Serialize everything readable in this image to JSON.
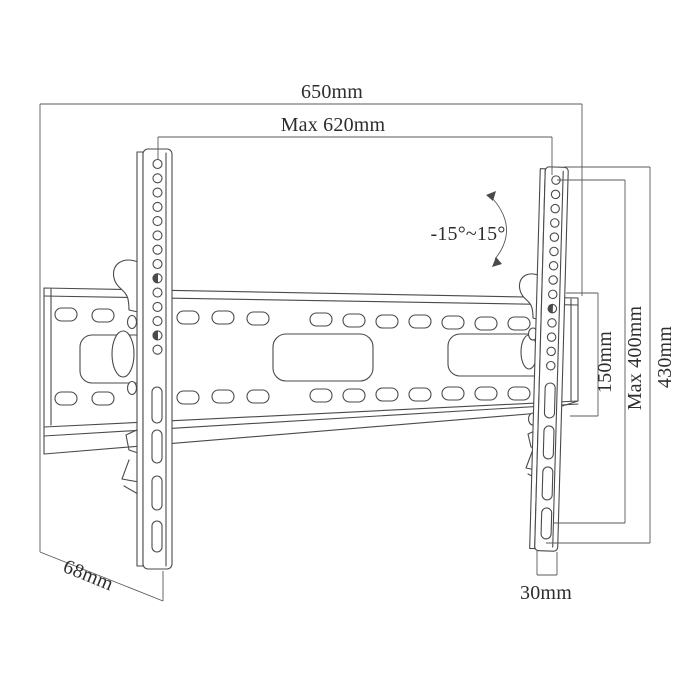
{
  "diagram": {
    "type": "technical-dimension-drawing",
    "subject": "tilting TV wall mount bracket",
    "background_color": "#ffffff",
    "line_color": "#4a4a4a",
    "text_color": "#2d2d2d",
    "labels": {
      "total_width": "650mm",
      "max_plate_width": "Max 620mm",
      "tilt_range": "-15°~15°",
      "hole_spacing": "150mm",
      "max_vesa_height": "Max 400mm",
      "bracket_height": "430mm",
      "depth": "68mm",
      "bracket_width": "30mm"
    }
  }
}
